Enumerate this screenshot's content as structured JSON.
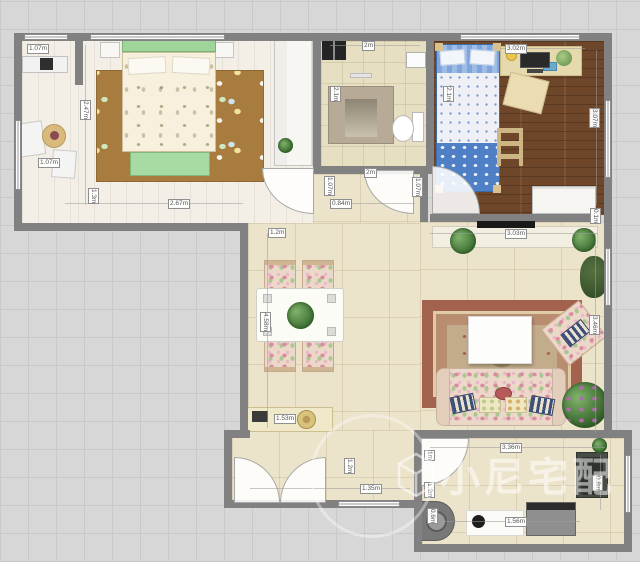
{
  "watermark": {
    "text": "小尼宅配",
    "logo": "cube-diamond-logo"
  },
  "colors": {
    "canvas": "#d7d7d7",
    "wall": "#818181",
    "floor_wood_light": "#f3efe6",
    "floor_wood_dark": "#6e4629",
    "floor_tile": "#ece3cb",
    "floor_bath_tile": "#e6dfc1",
    "rug_confetti": "#a87c3e",
    "rug_ornate_border": "#a3624e",
    "bed_green": "#9fd49b",
    "kids_bed_blue": "#5d8fd0",
    "plant_green": "#3e6e33",
    "watermark": "rgba(255,255,255,0.52)"
  },
  "labels": [
    {
      "id": "balcony-window-width",
      "text": "1.07m"
    },
    {
      "id": "balcony-depth",
      "text": "2.47m"
    },
    {
      "id": "balcony-width",
      "text": "1.07m"
    },
    {
      "id": "bedroom-width",
      "text": "2.67m"
    },
    {
      "id": "bedroom-wall-left",
      "text": "1.3m"
    },
    {
      "id": "bathroom-width",
      "text": "2m"
    },
    {
      "id": "shower-depth",
      "text": "2.1m"
    },
    {
      "id": "kids-bed-length",
      "text": "2.1m"
    },
    {
      "id": "desk-wall-width",
      "text": "3.02m"
    },
    {
      "id": "kids-room-depth",
      "text": "3.07m"
    },
    {
      "id": "bathroom-bottom-width",
      "text": "2m"
    },
    {
      "id": "hallway-width",
      "text": "0.84m"
    },
    {
      "id": "hallway-left-height",
      "text": "1.07m"
    },
    {
      "id": "hallway-right-height",
      "text": "1.07m"
    },
    {
      "id": "dining-top-width",
      "text": "1.2m"
    },
    {
      "id": "living-width",
      "text": "3.03m"
    },
    {
      "id": "living-wall-offset",
      "text": "0.1m"
    },
    {
      "id": "living-depth",
      "text": "3.46m"
    },
    {
      "id": "dining-depth",
      "text": "4.58m"
    },
    {
      "id": "sideboard-width",
      "text": "1.53m"
    },
    {
      "id": "entry-depth",
      "text": "1.2m"
    },
    {
      "id": "entry-width",
      "text": "1.35m"
    },
    {
      "id": "kitchen-width",
      "text": "3.36m"
    },
    {
      "id": "kitchen-left-a",
      "text": "1m"
    },
    {
      "id": "kitchen-left-b",
      "text": "1.2m"
    },
    {
      "id": "kitchen-counter-depth",
      "text": "0.6m"
    },
    {
      "id": "kitchen-counter-width",
      "text": "1.56m"
    },
    {
      "id": "sink-depth",
      "text": "0.8m"
    }
  ]
}
